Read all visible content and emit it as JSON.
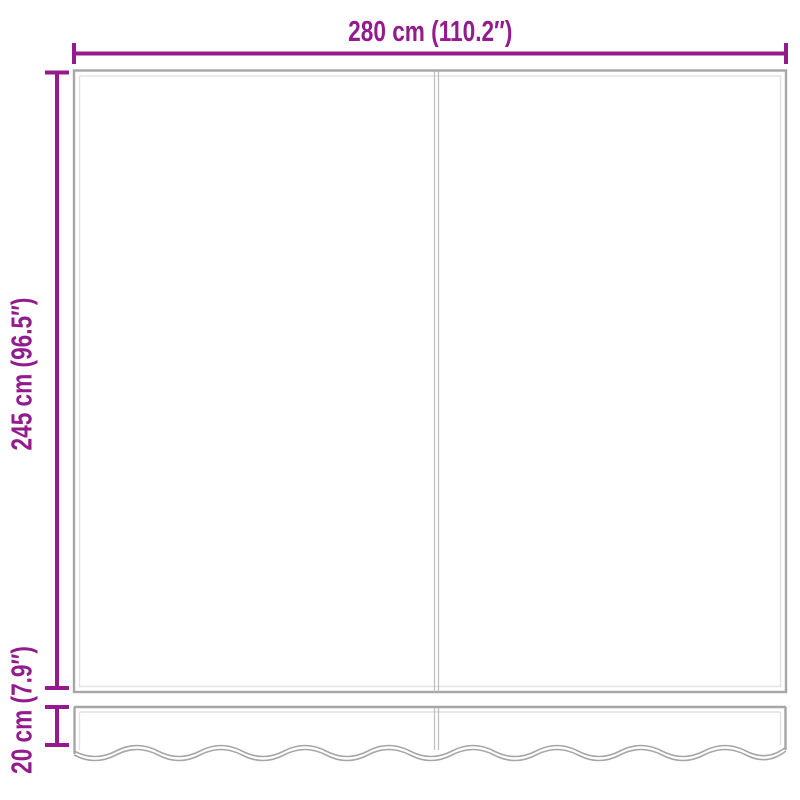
{
  "diagram": {
    "labels": {
      "width": "280 cm (110.2″)",
      "height": "245 cm (96.5″)",
      "valance_height": "20 cm (7.9″)"
    },
    "colors": {
      "dimension": "#931b8e",
      "outline": "#a6a6a6",
      "outline_light": "#e2e2e2",
      "seam": "#c0c0c0",
      "background": "#ffffff"
    }
  }
}
